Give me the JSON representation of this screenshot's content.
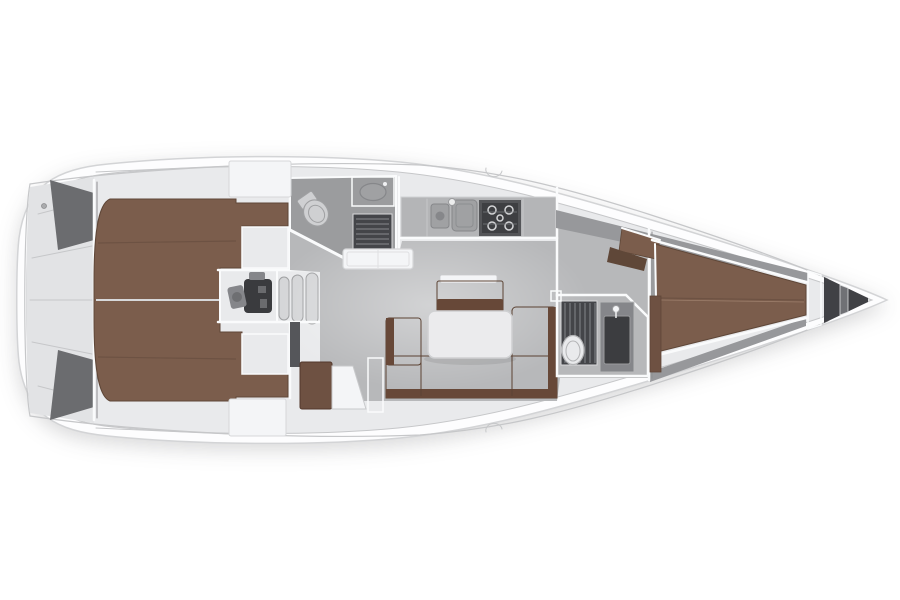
{
  "diagram": {
    "label": "sailing-yacht-interior-layout-plan-top-view",
    "orientation": "bow-right"
  },
  "canvas": {
    "width": 900,
    "height": 600,
    "background": "#ffffff"
  },
  "colors": {
    "background": "#ffffff",
    "hull": "#fdfdfe",
    "hull_outline": "#d3d4d6",
    "deck": "#e9eaec",
    "deck_line": "#c6c7c9",
    "deck_panel": "#e2e3e5",
    "white_box": "#f4f5f7",
    "white_box_line": "#d6d7d9",
    "floor": "#b7b8ba",
    "floor_dark": "#9b9c9e",
    "floor_darker": "#8b8c8f",
    "wall_dark": "#6b6c6f",
    "wall_dark2": "#55565a",
    "berth": "#7b5d4c",
    "berth_dark": "#5f4738",
    "berth_seam": "#6d5243",
    "settee": "#7a5a49",
    "settee_dark": "#674838",
    "wood_dark": "#6e5142",
    "table": "#ebebed",
    "table_line": "#cfd0d2",
    "counter": "#b4b5b7",
    "sink": "#a0a1a3",
    "sink_dark": "#86878a",
    "stove": "#3e3f42",
    "stove_frame": "#545558",
    "burner": "#d4d5d7",
    "grate": "#444549",
    "grate_slat": "#7b7c80",
    "porcelain": "#e9eaec",
    "porcelain_line": "#b3b4b6",
    "porcelain_gray": "#cfd0d2",
    "cabinet": "#85868a",
    "cabinet_door": "#3c3d40",
    "engine_floor": "#5c5d60",
    "engine": "#3a3b3e",
    "engine_light": "#85868a",
    "liner": "#97989b",
    "bulkhead_light": "#a9aaad",
    "anchor": "#404145",
    "anchor_divider": "#707175",
    "post": "#2f3033",
    "step": "#d4d5d7"
  },
  "areas": [
    {
      "id": "hull",
      "label": "hull outline"
    },
    {
      "id": "stern-lazarette",
      "label": "stern lazarette lockers"
    },
    {
      "id": "aft-cabin-berths",
      "label": "twin aft double berths"
    },
    {
      "id": "engine-compartment",
      "label": "engine compartment"
    },
    {
      "id": "companionway-steps",
      "label": "companionway steps"
    },
    {
      "id": "aft-head",
      "label": "aft head with shower grate, sink and toilet"
    },
    {
      "id": "galley",
      "label": "galley with twin sinks and stove"
    },
    {
      "id": "saloon",
      "label": "saloon with U-settee, table and sideboard"
    },
    {
      "id": "nav-corner",
      "label": "chart table corner and mast post"
    },
    {
      "id": "forward-head",
      "label": "forward head with shower, toilet and vanity"
    },
    {
      "id": "forward-cabin",
      "label": "forward cabin V-berth"
    },
    {
      "id": "hanging-locker",
      "label": "hanging locker"
    },
    {
      "id": "corner-seat",
      "label": "forward cabin corner seats"
    },
    {
      "id": "bow-bulkhead",
      "label": "collision bulkhead"
    },
    {
      "id": "anchor-locker",
      "label": "anchor locker"
    },
    {
      "id": "deck-hatch",
      "label": "coachroof hatch"
    }
  ]
}
